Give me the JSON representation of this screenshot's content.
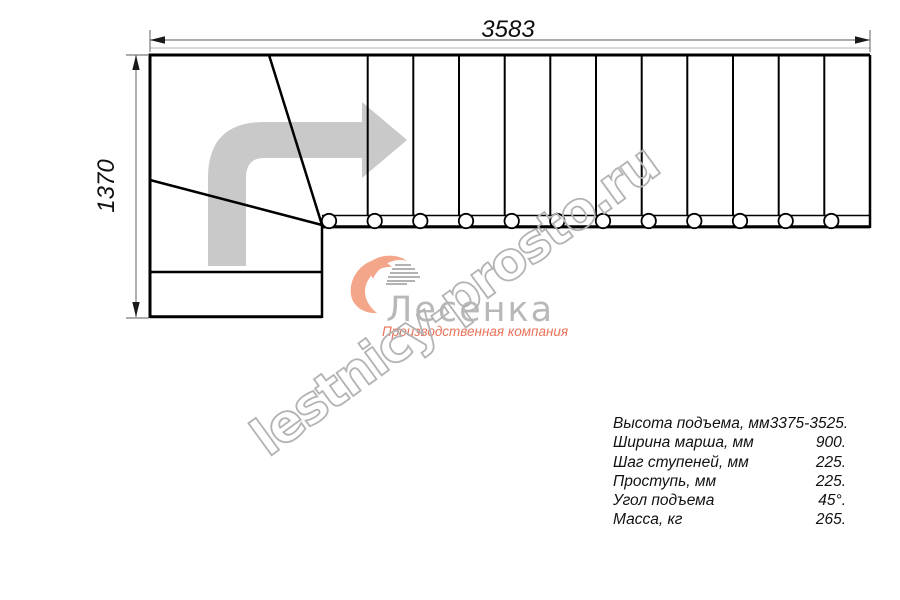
{
  "drawing": {
    "dim_width_label": "3583",
    "dim_height_label": "1370",
    "straight_steps": 12,
    "balusters": 12,
    "winder_tread_edges": 2,
    "colors": {
      "outline": "#000000",
      "dimension_line": "#7a7a7a",
      "direction_arrow": "#c9c9c9",
      "faint_guide_line": "#c4c4c4"
    }
  },
  "watermark": {
    "text": "lestnicy-prosto.ru",
    "color": "#b3b3b3"
  },
  "logo": {
    "name": "Лесенка",
    "tagline": "Производственная компания",
    "accent_color": "#f4a68b",
    "steps_color": "#9a9a9a",
    "name_color": "#b8b8b8",
    "tagline_color": "#e9735a"
  },
  "specs": {
    "rows": [
      {
        "label": "Высота подъема, мм",
        "value": "3375-3525."
      },
      {
        "label": "Ширина марша, мм",
        "value": "900."
      },
      {
        "label": "Шаг ступеней, мм",
        "value": "225."
      },
      {
        "label": "Проступь, мм",
        "value": "225."
      },
      {
        "label": "Угол подъема",
        "value": "45°."
      },
      {
        "label": "Масса, кг",
        "value": "265."
      }
    ]
  }
}
